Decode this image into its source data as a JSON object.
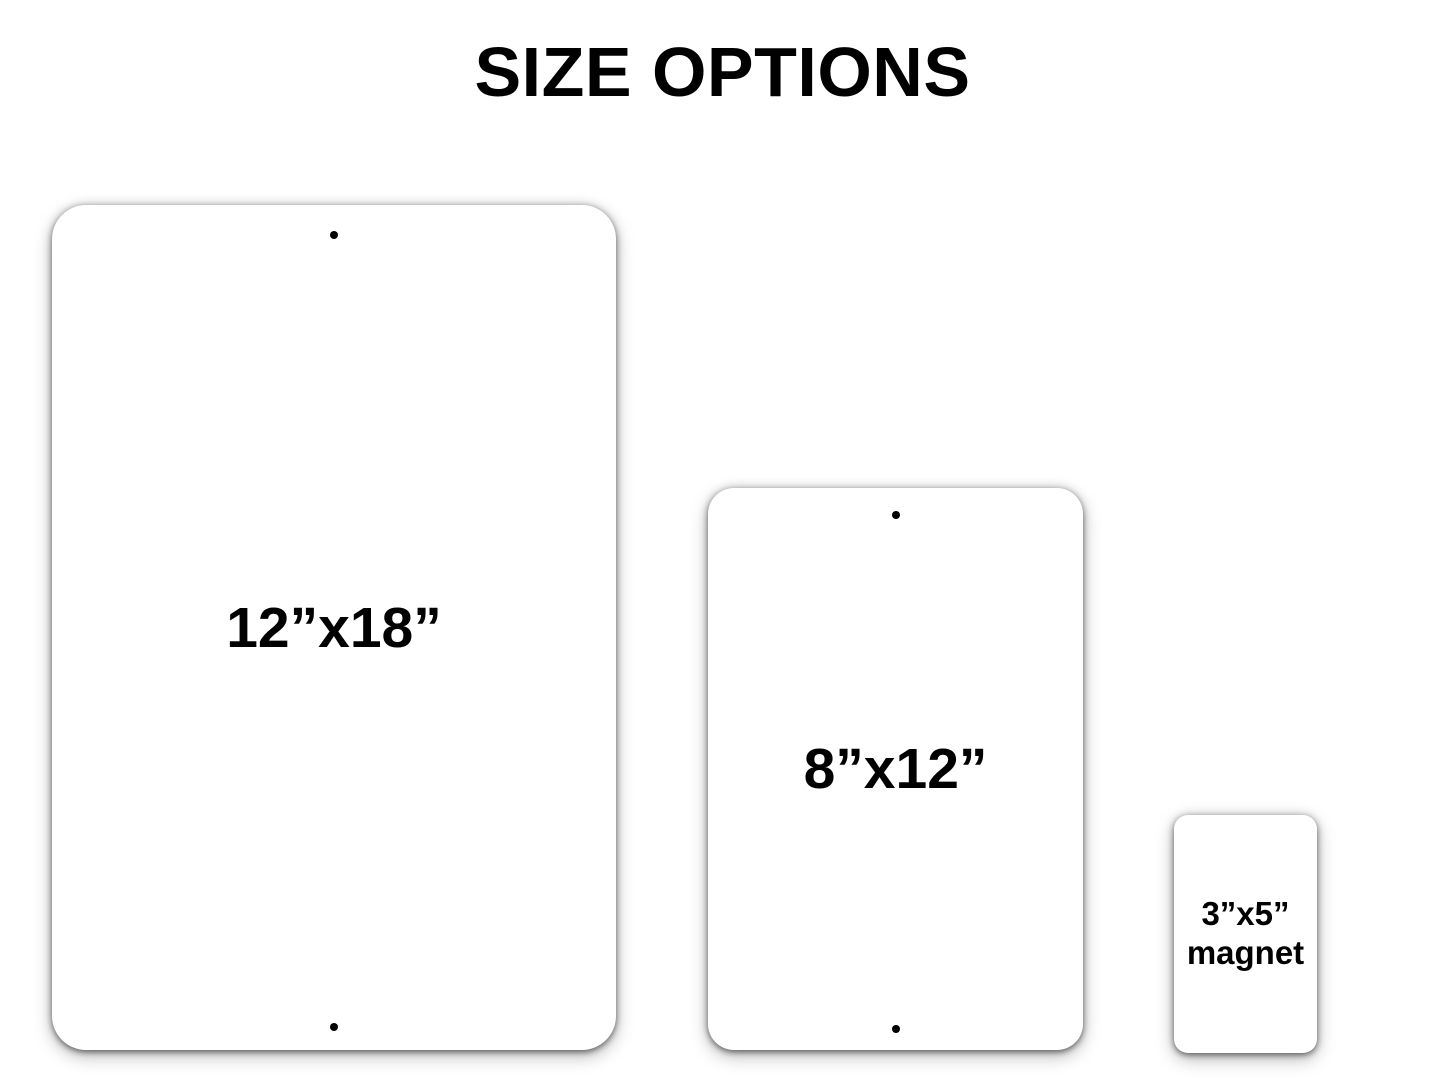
{
  "title": "SIZE OPTIONS",
  "colors": {
    "background": "#ffffff",
    "text": "#000000",
    "panel_fill": "#ffffff",
    "hole": "#000000"
  },
  "panels": {
    "large": {
      "label": "12”x18”",
      "mounting_holes": 2
    },
    "medium": {
      "label": "8”x12”",
      "mounting_holes": 2
    },
    "magnet": {
      "label_line1": "3”x5”",
      "label_line2": "magnet",
      "mounting_holes": 0
    }
  }
}
